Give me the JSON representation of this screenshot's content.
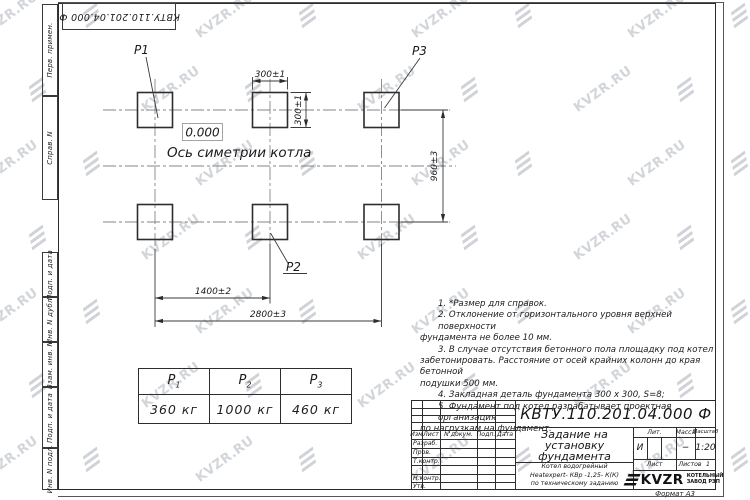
{
  "sheet": {
    "stamp_rotated": "КВТУ.110.201.04.000  Ф",
    "format_label": "Формат А3"
  },
  "watermark": {
    "text": "KVZR.RU",
    "color": "#8a909c"
  },
  "margin_labels": {
    "perv": "Перв. примен.",
    "sprav": "Справ. N",
    "podp1": "Подп. и дата",
    "inv_dubl": "Инв. N дубл.",
    "vzam": "Взам. инв. N",
    "podp2": "Подп. и дата",
    "inv_podl": "Инв. N подл."
  },
  "drawing": {
    "elevation": "0.000",
    "axis_label": "Ось симетрии котла",
    "labels": {
      "p1": "Р1",
      "p2": "Р2",
      "p3": "Р3"
    },
    "dims": {
      "width_top": "300±1",
      "height_right": "300±1",
      "row_spacing": "960±3",
      "col_spacing": "1400±2",
      "total_width": "2800±3"
    }
  },
  "notes": {
    "lines": [
      "1. *Размер для справок.",
      "2. Отклонение от горизонтального уровня верхней поверхности",
      "фундамента не более 10 мм.",
      "3. В случае отсутствия бетонного пола площадку под котел",
      "забетонировать. Расстояние от осей крайних колонн до края бетонной",
      "подушки 500 мм.",
      "4. Закладная деталь фундамента  300 х 300, S=8;",
      "5. Фундамент под котел разрабатывает проектная организация",
      "по нагрузкам на фундамент."
    ]
  },
  "load_table": {
    "columns": [
      {
        "sym": "Р",
        "sub": "1",
        "value": "360 кг"
      },
      {
        "sym": "Р",
        "sub": "2",
        "value": "1000 кг"
      },
      {
        "sym": "Р",
        "sub": "3",
        "value": "460 кг"
      }
    ]
  },
  "titleblock": {
    "designation": "КВТУ.110.201.04.000  Ф",
    "title_lines": [
      "Задание на",
      "установку",
      "фундамента"
    ],
    "subtitle_lines": [
      "Котел водогрейный",
      "Heatexpert- КВр -1,25- К(К)",
      "по техническому заданию"
    ],
    "header_cols": [
      "Изм",
      "Лист",
      "N докум.",
      "Подп.",
      "Дата"
    ],
    "row_labels": [
      "Разраб.",
      "Пров.",
      "Т.контр.",
      "Н.контр.",
      "Утв."
    ],
    "lit_label": "Лит.",
    "mass_label": "Масса",
    "scale_label": "Масштаб",
    "lit_value": "И",
    "mass_value": "−",
    "scale_value": "1:20",
    "sheet_label": "Лист",
    "sheets_label": "Листов",
    "sheets_value": "1",
    "company": {
      "logo_text": "KVZR",
      "name_line1": "КОТЕЛЬНЫЙ",
      "name_line2": "ЗАВОД РЭП"
    }
  }
}
